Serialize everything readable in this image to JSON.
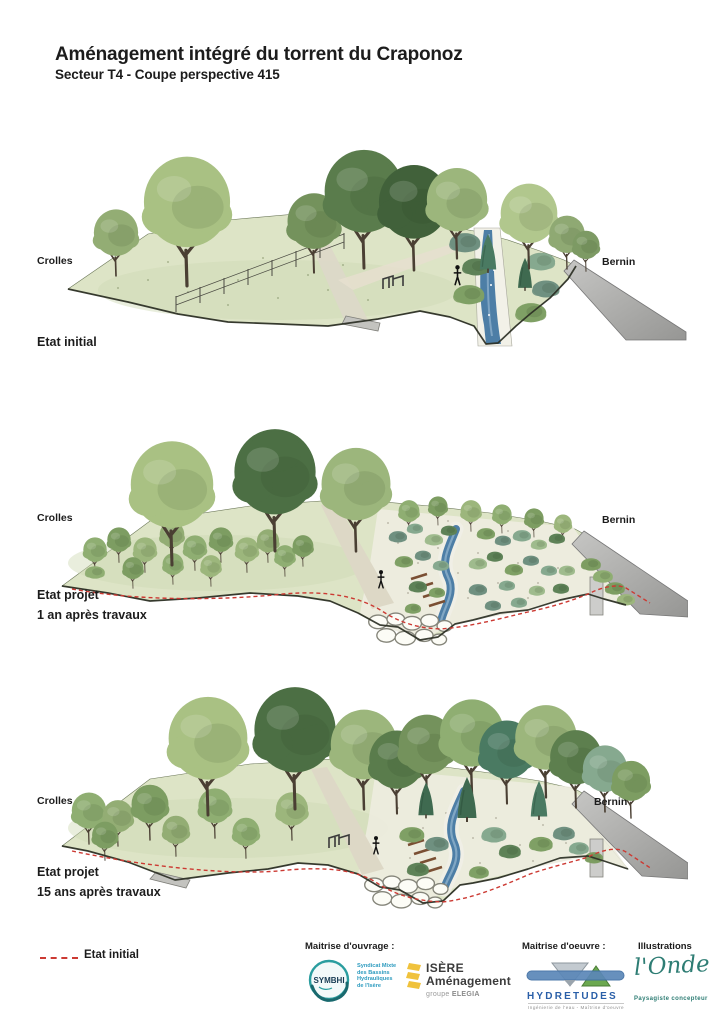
{
  "page": {
    "title": "Aménagement intégré du torrent du Craponoz",
    "subtitle": "Secteur T4 - Coupe perspective 415"
  },
  "sections": [
    {
      "left_label": "Crolles",
      "right_label": "Bernin",
      "caption": "Etat initial"
    },
    {
      "left_label": "Crolles",
      "right_label": "Bernin",
      "caption": "Etat projet\n1 an après travaux"
    },
    {
      "left_label": "Crolles",
      "right_label": "Bernin",
      "caption": "Etat projet\n15 ans après travaux"
    }
  ],
  "legend": {
    "label": "Etat initial"
  },
  "footer": {
    "ouvrage_heading": "Maitrise d'ouvrage :",
    "symbhi": {
      "acronym": "SYMBHI",
      "description": "Syndicat Mixte\ndes Bassins\nHydrauliques\nde l'Isère"
    },
    "isere": {
      "line1": "ISÈRE",
      "line2": "Aménagement",
      "group_prefix": "groupe ",
      "group_name": "ELEGIA"
    },
    "oeuvre_heading": "Maitrise d'oeuvre :",
    "hydretudes": {
      "name": "HYDRETUDES",
      "tagline": "Ingénierie de l'eau - Maîtrise d'oeuvre"
    },
    "illustrations_heading": "Illustrations",
    "onde": {
      "name": "l'Onde",
      "tagline": "Paysagiste concepteur"
    }
  },
  "colors": {
    "accent_red": "#cc3a33",
    "stream_blue": "#4d7ea6",
    "road_gray": "#a9a9a9",
    "symbhi_teal": "#2a9d9f",
    "hydretudes_blue": "#2a5fa8",
    "onde_teal": "#2e7d74",
    "isere_yellow": "#f0c23c"
  }
}
